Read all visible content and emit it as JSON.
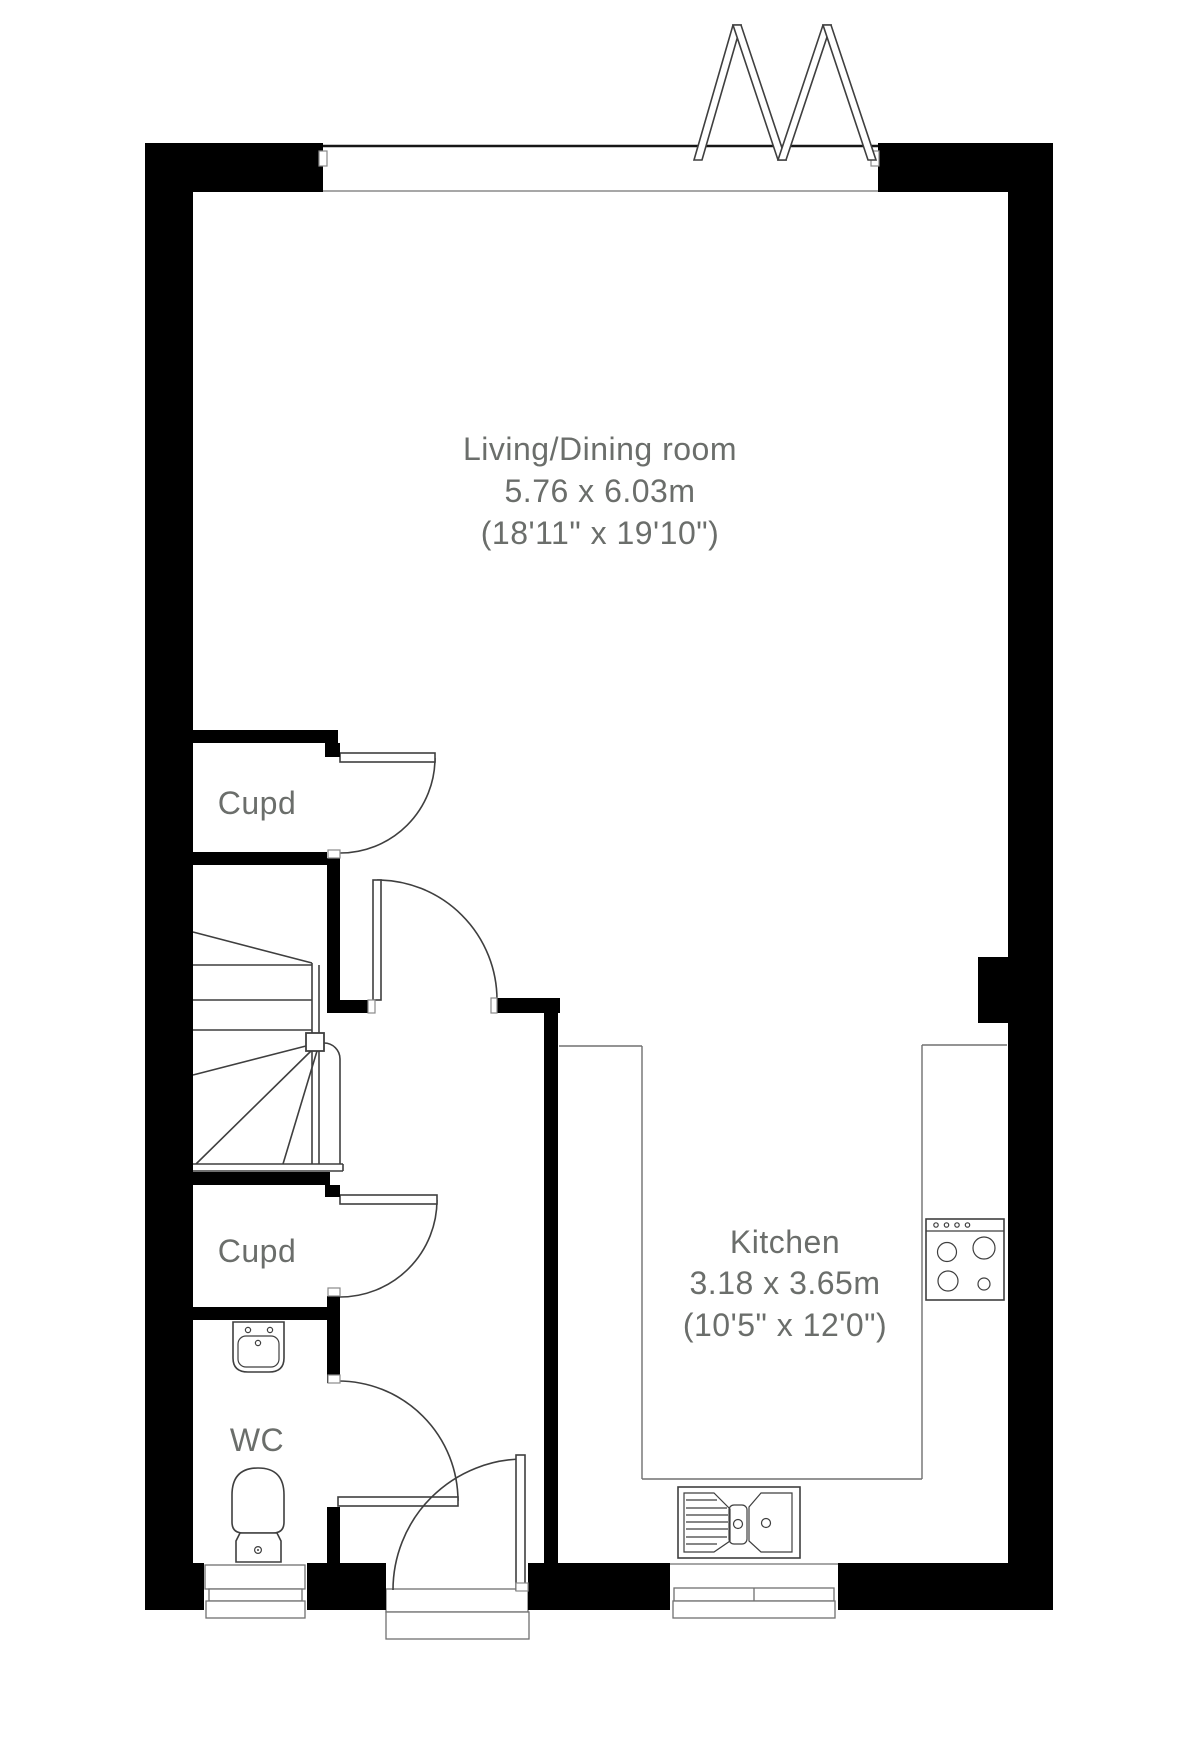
{
  "rooms": {
    "living": {
      "name": "Living/Dining room",
      "metric": "5.76 x 6.03m",
      "imperial": "(18'11\" x 19'10\")"
    },
    "kitchen": {
      "name": "Kitchen",
      "metric": "3.18 x 3.65m",
      "imperial": "(10'5\" x 12'0\")"
    },
    "cupboard_upper": {
      "name": "Cupd"
    },
    "cupboard_lower": {
      "name": "Cupd"
    },
    "wc": {
      "name": "WC"
    }
  },
  "colors": {
    "wall": "#000000",
    "stroke": "#3f3f3f",
    "thin": "#8a8a8a",
    "counter": "#707070",
    "label": "#6b6e6b",
    "background": "#ffffff"
  }
}
